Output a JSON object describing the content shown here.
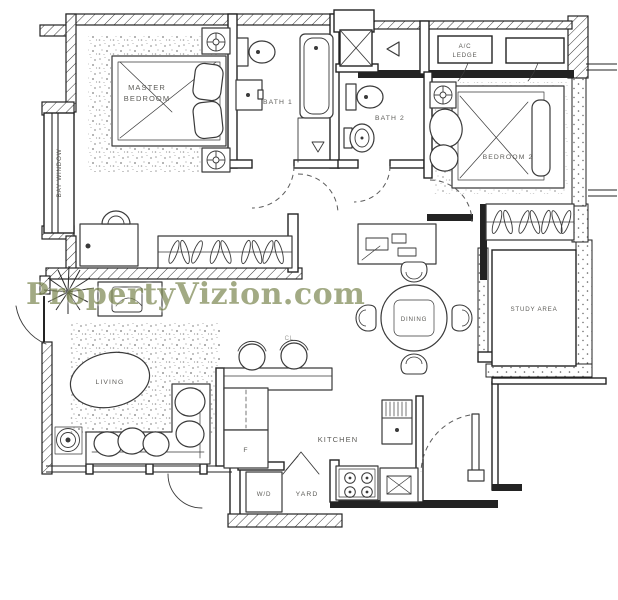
{
  "watermark": {
    "text": "PropertyVizion.com"
  },
  "labels": {
    "master_bedroom_l1": "MASTER",
    "master_bedroom_l2": "BEDROOM",
    "bath1": "BATH 1",
    "bath2": "BATH 2",
    "ac_ledge_l1": "A/C",
    "ac_ledge_l2": "LEDGE",
    "bedroom2": "BEDROOM 2",
    "bay_window": "BAY WINDOW",
    "living": "LIVING",
    "dining": "DINING",
    "kitchen": "KITCHEN",
    "study_area": "STUDY AREA",
    "wd": "W/D",
    "yard": "YARD",
    "fridge": "F",
    "cl": "CL"
  },
  "colors": {
    "wall": "#232323",
    "furniture": "#3a3a3a",
    "label": "#5d5c58",
    "watermark": "#7f8a55"
  }
}
